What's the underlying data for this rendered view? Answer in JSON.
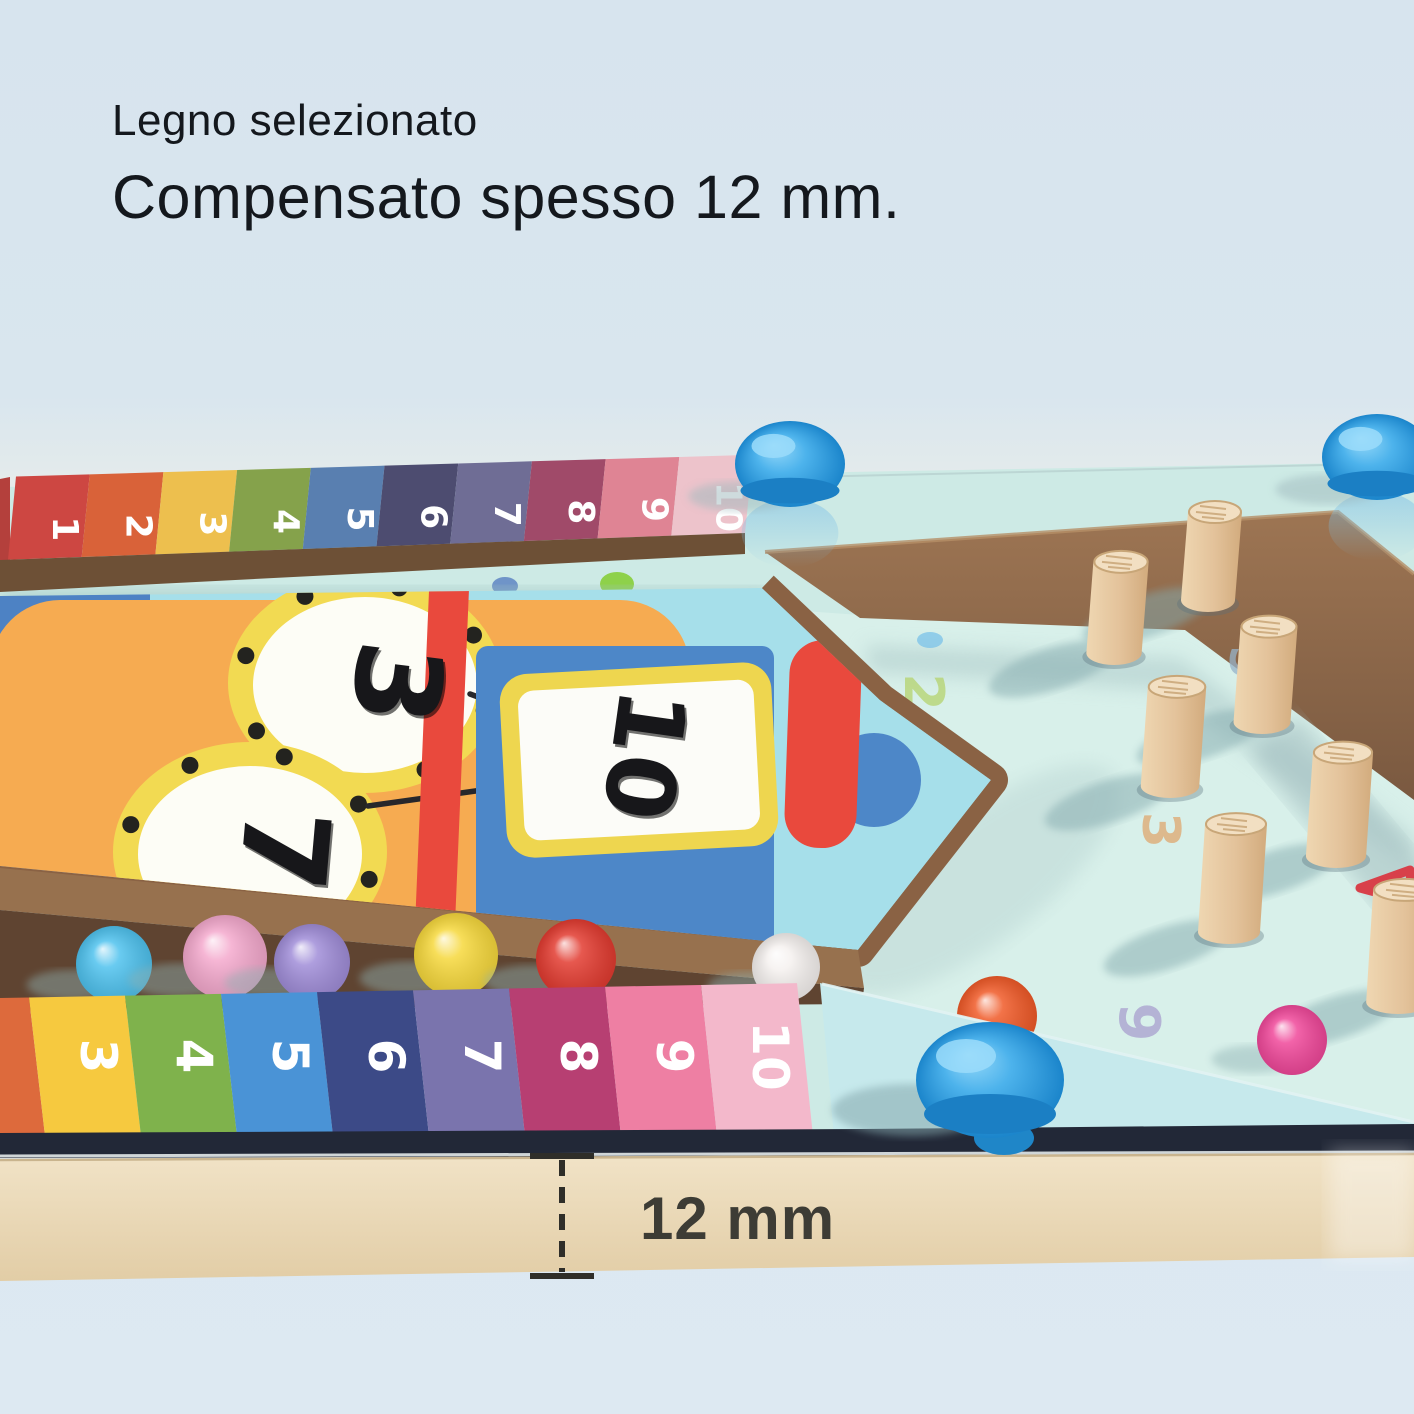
{
  "header": {
    "line1": "Legno selezionato",
    "line2": "Compensato spesso 12 mm."
  },
  "measurement": {
    "label": "12 mm",
    "line_color": "#2f2e29",
    "text_color": "#3d3c35"
  },
  "board": {
    "top_scale": {
      "labels": [
        "1",
        "2",
        "3",
        "4",
        "5",
        "6",
        "7",
        "8",
        "9",
        "10"
      ],
      "colors": [
        "#cd4742",
        "#d96239",
        "#edbf4e",
        "#85a24b",
        "#597fb0",
        "#4d4c70",
        "#6f6d95",
        "#a04a69",
        "#df8494",
        "#edc3cb"
      ],
      "number_color": "#ffffff"
    },
    "bottom_scale": {
      "labels": [
        "",
        "3",
        "4",
        "5",
        "6",
        "7",
        "8",
        "9",
        "10"
      ],
      "colors": [
        "#dd6a3c",
        "#f6c93f",
        "#7fb24c",
        "#4a93d6",
        "#3c4a87",
        "#7a74ad",
        "#b73f72",
        "#ee7fa3",
        "#f3b8cb"
      ],
      "number_color": "#ffffff"
    },
    "clay_numbers": [
      {
        "value": "3",
        "x": 356,
        "y": 678,
        "size": 118,
        "rot": 97
      },
      {
        "value": "7",
        "x": 243,
        "y": 846,
        "size": 118,
        "rot": 95
      },
      {
        "value": "10",
        "x": 612,
        "y": 750,
        "size": 94,
        "rot": 98
      }
    ],
    "printed_numbers": [
      {
        "value": "2",
        "x": 905,
        "y": 692,
        "color": "#b5d36d",
        "size": 54
      },
      {
        "value": "5",
        "x": 1230,
        "y": 662,
        "color": "#97b3c9",
        "size": 48
      },
      {
        "value": "3",
        "x": 1143,
        "y": 830,
        "color": "#dfa76f",
        "size": 52
      },
      {
        "value": "9",
        "x": 1120,
        "y": 1022,
        "color": "#a89fce",
        "size": 56
      },
      {
        "value": "4",
        "x": 1406,
        "y": 890,
        "color": "#dd5849",
        "size": 58
      }
    ],
    "pegs": [
      [
        1208,
        600
      ],
      [
        1114,
        653
      ],
      [
        1262,
        722
      ],
      [
        1170,
        786
      ],
      [
        1336,
        856
      ],
      [
        1229,
        932
      ],
      [
        1398,
        1002
      ]
    ],
    "pocket_balls": [
      {
        "x": 997,
        "y": 1016,
        "r": 40,
        "color": "#f05a28"
      },
      {
        "x": 1292,
        "y": 1040,
        "r": 35,
        "color": "#f0489a"
      }
    ],
    "tray_balls": [
      {
        "x": 114,
        "y": 964,
        "r": 38,
        "color": "#4fc2ee"
      },
      {
        "x": 225,
        "y": 957,
        "r": 42,
        "color": "#f4a9cd"
      },
      {
        "x": 312,
        "y": 962,
        "r": 38,
        "color": "#a08dd8"
      },
      {
        "x": 456,
        "y": 955,
        "r": 42,
        "color": "#f6d83c"
      },
      {
        "x": 576,
        "y": 959,
        "r": 40,
        "color": "#e23b30"
      },
      {
        "x": 786,
        "y": 967,
        "r": 34,
        "color": "#f5f1ef"
      }
    ],
    "gap_balls": [
      {
        "x": 617,
        "y": 584,
        "rx": 17,
        "ry": 12,
        "color": "#8ed14a"
      },
      {
        "x": 505,
        "y": 586,
        "rx": 13,
        "ry": 9,
        "color": "#6f94c8"
      }
    ],
    "knobs": {
      "back": [
        [
          790,
          464
        ],
        [
          1377,
          457
        ]
      ],
      "front": [
        990,
        1080
      ],
      "color_top": "#8ed4f4",
      "color_main": "#2196dc"
    },
    "droplets": [
      [
        930,
        640
      ],
      [
        1205,
        1086
      ]
    ],
    "colors": {
      "mint": "#cdeae5",
      "pocket_floor": "#d8f0ea",
      "front_rim": "#c6e9ec",
      "wall_wood": "#91694a",
      "edge_wood": "#6d5036",
      "trough_dark": "#5f4431",
      "plywood": "#ecdebf",
      "groove": "#222837",
      "panel_orange": "#f6ab51",
      "panel_cyan": "#a6dfea",
      "robot_blue": "#4d87c8",
      "accent_red": "#e9493d",
      "ring_yellow": "#f2da52",
      "card_yellow": "#eed64f",
      "clay_black": "#17171a",
      "peg_wood": "#e3c29a"
    }
  }
}
